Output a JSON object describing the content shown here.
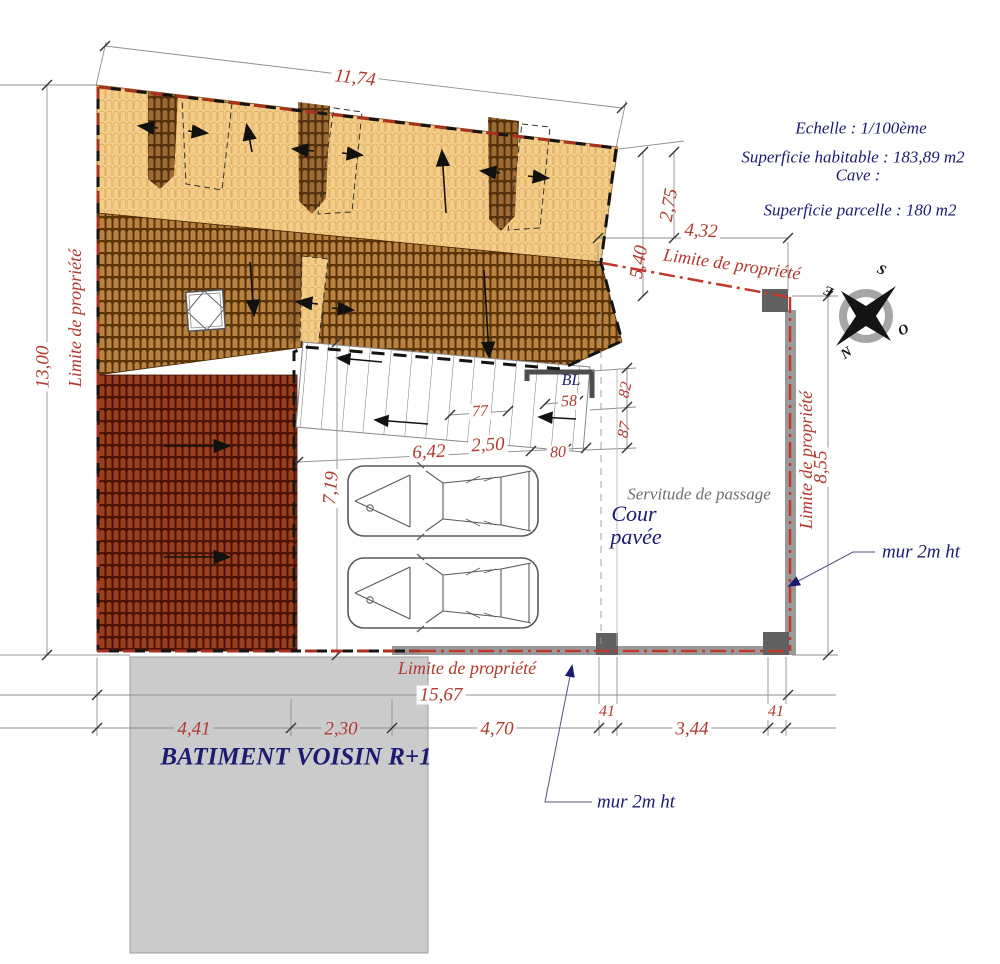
{
  "info_block": {
    "scale": "Echelle : 1/100ème",
    "habitable": "Superficie habitable : 183,89 m2",
    "cave": "Cave :",
    "parcel": "Superficie parcelle : 180 m2"
  },
  "labels": {
    "limite": "Limite de propriété",
    "servitude": "Servitude de passage",
    "cour_line1": "Cour",
    "cour_line2": "pavée",
    "mur": "mur 2m ht",
    "bl": "BL",
    "neighbor": "BATIMENT VOISIN R+1"
  },
  "compass": {
    "n": "N",
    "s": "S",
    "e": "E",
    "o": "O"
  },
  "dims": {
    "top_width": "11,74",
    "left_height": "13,00",
    "r275": "2,75",
    "r432": "4,32",
    "r540": "5,40",
    "right_height": "8,55",
    "court_height": "7,19",
    "s642": "6,42",
    "s250": "2,50",
    "s80": "80",
    "s77": "77",
    "s58": "58",
    "s82": "82",
    "s87": "87",
    "total_width": "15,67",
    "b441": "4,41",
    "b230": "2,30",
    "b470": "4,70",
    "b41a": "41",
    "b344": "3,44",
    "b41b": "41"
  },
  "colors": {
    "dim_red": "#b03a30",
    "text_blue": "#1b1b70",
    "servitude_gray": "#6e6e6e",
    "limite_red": "#c0392b",
    "roof_tan": "#f5d191",
    "roof_brown": "#5f3608",
    "roof_darkred": "#4f1507",
    "wall_gray": "#9a9a9a",
    "neighbor_gray": "#cbcbcb"
  }
}
